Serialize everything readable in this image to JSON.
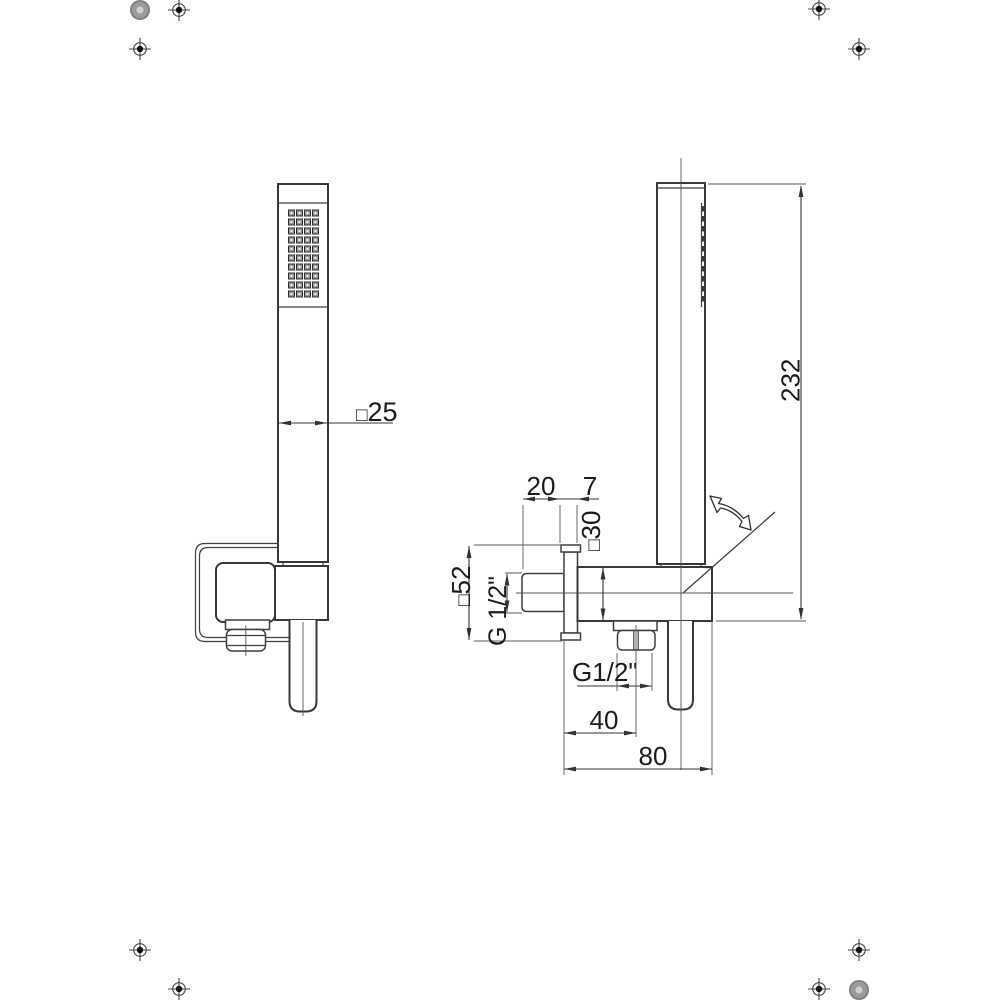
{
  "meta": {
    "background": "#ffffff",
    "line_color": "#383838",
    "text_color": "#1b1b1b",
    "drawing_type": "shower-set-technical-drawing"
  },
  "dims": {
    "square_symbol": "□",
    "handle_width": "25",
    "shower_length": "232",
    "outlet_protrusion": "20",
    "plate_thickness": "7",
    "holder_height": "30",
    "plate_size": "52",
    "inlet_thread": "G 1/2\"",
    "hose_thread": "G1/2\"",
    "hose_outlet_offset": "40",
    "holder_depth": "80"
  }
}
